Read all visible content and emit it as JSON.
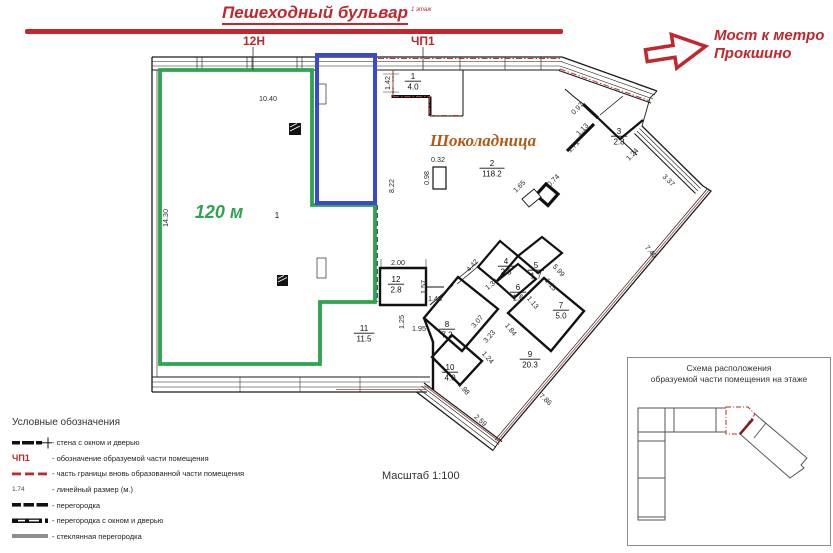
{
  "header": {
    "title": "Пешеходный бульвар",
    "title_superscript": "1 этаж",
    "label_12n": "12Н",
    "label_chp1": "ЧП1",
    "arrow_text_line1": "Мост к метро",
    "arrow_text_line2": "Прокшино"
  },
  "plan": {
    "brand_label": "Шоколадница",
    "highlight_area_label": "120 м",
    "scale_label": "Масштаб 1:100",
    "rooms": [
      {
        "num": "1",
        "area": "",
        "x": 277,
        "y": 218
      },
      {
        "num": "1",
        "area": "4.0",
        "x": 413,
        "y": 79
      },
      {
        "num": "2",
        "area": "118.2",
        "x": 492,
        "y": 166
      },
      {
        "num": "3",
        "area": "2.8",
        "x": 619,
        "y": 134
      },
      {
        "num": "4",
        "area": "2.8",
        "x": 506,
        "y": 264
      },
      {
        "num": "5",
        "area": "1.7",
        "x": 536,
        "y": 268
      },
      {
        "num": "6",
        "area": "1.6",
        "x": 518,
        "y": 290
      },
      {
        "num": "7",
        "area": "5.0",
        "x": 561,
        "y": 308
      },
      {
        "num": "8",
        "area": "7.2",
        "x": 447,
        "y": 327
      },
      {
        "num": "9",
        "area": "20.3",
        "x": 530,
        "y": 357
      },
      {
        "num": "10",
        "area": "4.0",
        "x": 450,
        "y": 370
      },
      {
        "num": "11",
        "area": "11.5",
        "x": 364,
        "y": 331
      },
      {
        "num": "12",
        "area": "2.8",
        "x": 396,
        "y": 282
      }
    ],
    "dims": [
      {
        "v": "10.40",
        "x": 268,
        "y": 101,
        "r": 0
      },
      {
        "v": "14.30",
        "x": 168,
        "y": 218,
        "r": -90
      },
      {
        "v": "1.42",
        "x": 390,
        "y": 83,
        "r": -90
      },
      {
        "v": "8.22",
        "x": 394,
        "y": 186,
        "r": -90
      },
      {
        "v": "0.32",
        "x": 438,
        "y": 162,
        "r": 0
      },
      {
        "v": "0.98",
        "x": 429,
        "y": 178,
        "r": -90
      },
      {
        "v": "0.97",
        "x": 579,
        "y": 110,
        "r": -45
      },
      {
        "v": "1.13",
        "x": 584,
        "y": 131,
        "r": -45
      },
      {
        "v": "1.71",
        "x": 575,
        "y": 148,
        "r": -45
      },
      {
        "v": "1.24",
        "x": 634,
        "y": 156,
        "r": -45
      },
      {
        "v": "3.37",
        "x": 667,
        "y": 182,
        "r": 44
      },
      {
        "v": "7.40",
        "x": 649,
        "y": 253,
        "r": 50
      },
      {
        "v": "1.65",
        "x": 521,
        "y": 188,
        "r": -45
      },
      {
        "v": "0.74",
        "x": 555,
        "y": 182,
        "r": -45
      },
      {
        "v": "2.00",
        "x": 398,
        "y": 265,
        "r": 0
      },
      {
        "v": "1.57",
        "x": 426,
        "y": 287,
        "r": -90
      },
      {
        "v": "1.48",
        "x": 435,
        "y": 301,
        "r": 0
      },
      {
        "v": "1.25",
        "x": 404,
        "y": 322,
        "r": -90
      },
      {
        "v": "1.95",
        "x": 419,
        "y": 331,
        "r": 0
      },
      {
        "v": "4.42",
        "x": 474,
        "y": 267,
        "r": -48
      },
      {
        "v": "1.34",
        "x": 493,
        "y": 286,
        "r": -38
      },
      {
        "v": "5.99",
        "x": 557,
        "y": 272,
        "r": 47
      },
      {
        "v": "1.15",
        "x": 549,
        "y": 286,
        "r": 50
      },
      {
        "v": "1.13",
        "x": 531,
        "y": 304,
        "r": 50
      },
      {
        "v": "3.07",
        "x": 479,
        "y": 323,
        "r": -48
      },
      {
        "v": "3.23",
        "x": 491,
        "y": 338,
        "r": -48
      },
      {
        "v": "1.84",
        "x": 509,
        "y": 331,
        "r": 50
      },
      {
        "v": "1.24",
        "x": 486,
        "y": 359,
        "r": 48
      },
      {
        "v": "1.98",
        "x": 462,
        "y": 390,
        "r": 50
      },
      {
        "v": "7.86",
        "x": 544,
        "y": 401,
        "r": 42
      },
      {
        "v": "2.59",
        "x": 479,
        "y": 422,
        "r": 42
      }
    ]
  },
  "legend": {
    "title": "Условные обозначения",
    "items": [
      {
        "symbol": "wall-window-door",
        "label": "- стена с окном и дверью"
      },
      {
        "symbol": "chp-mark",
        "symbol_text": "ЧП1",
        "label": "- обозначение образуемой части помещения"
      },
      {
        "symbol": "red-dashed",
        "label": "- часть границы вновь образованной части помещения"
      },
      {
        "symbol": "linear-size",
        "symbol_text": "1.74",
        "label": "- линейный размер (м.)"
      },
      {
        "symbol": "partition",
        "label": "- перегородка"
      },
      {
        "symbol": "partition-window-door",
        "label": "- перегородка с окном и дверью"
      },
      {
        "symbol": "glass-partition",
        "label": "- стеклянная перегородка"
      }
    ]
  },
  "inset": {
    "title_line1": "Схема расположения",
    "title_line2": "образуемой части помещения на этаже"
  },
  "colors": {
    "accent_red": "#c1272d",
    "highlight_green": "#2ea44f",
    "highlight_blue": "#3b49cf",
    "brand_orange": "#b05a18"
  }
}
